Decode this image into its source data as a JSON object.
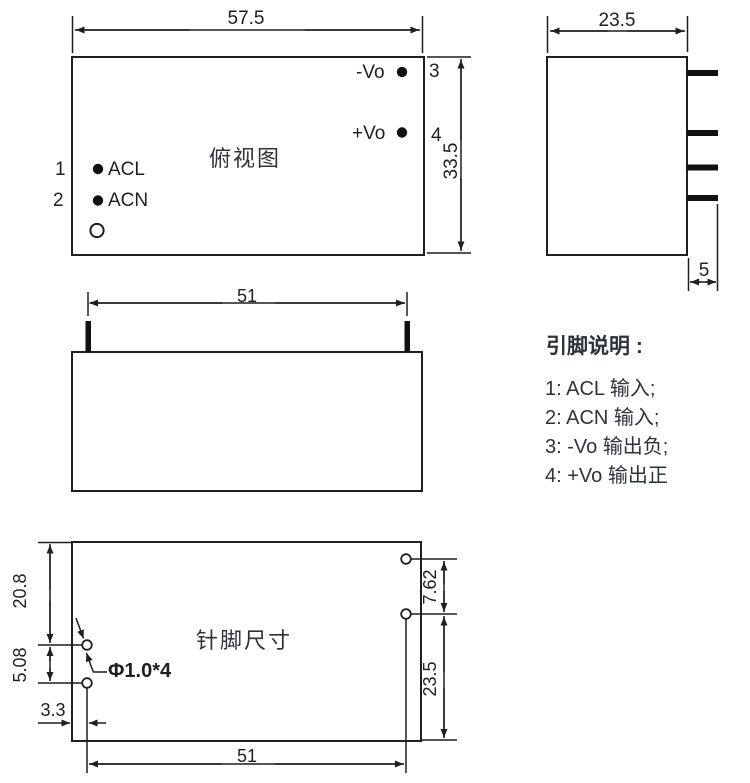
{
  "canvas": {
    "background": "#ffffff",
    "line_color": "#1f1f1f",
    "legend_text_color": "#2e333b"
  },
  "top_view": {
    "title": "俯视图",
    "dim_width": "57.5",
    "dim_height": "33.5",
    "pin1_num": "1",
    "pin1_label": "ACL",
    "pin2_num": "2",
    "pin2_label": "ACN",
    "pin3_num": "3",
    "pin3_label": "-Vo",
    "pin4_num": "4",
    "pin4_label": "+Vo"
  },
  "side_view": {
    "dim_width": "23.5",
    "dim_pin_length": "5"
  },
  "front_view": {
    "dim_pin_span": "51"
  },
  "bottom_view": {
    "title": "针脚尺寸",
    "dim_top_to_pin": "20.8",
    "dim_left_pitch": "5.08",
    "dim_left_offset": "3.3",
    "dim_pin_span": "51",
    "dim_right_pitch": "7.62",
    "dim_pin_to_bottom": "23.5",
    "hole_callout": "Φ1.0*4"
  },
  "legend": {
    "heading": "引脚说明 :",
    "items": [
      "1: ACL 输入;",
      "2: ACN 输入;",
      "3: -Vo 输出负;",
      "4: +Vo 输出正"
    ]
  }
}
